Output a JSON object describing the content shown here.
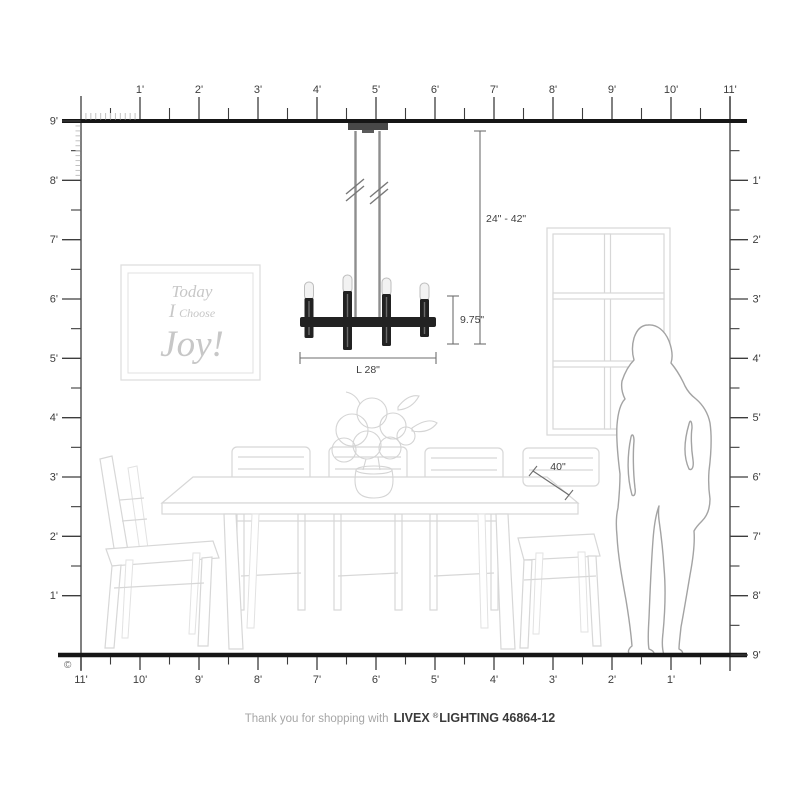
{
  "diagram": {
    "copyright": "©",
    "footer": {
      "prefix": "Thank you for shopping with",
      "brand": "LIVEX",
      "reg": "®",
      "suffix": "LIGHTING 46864-12"
    },
    "dimensions": {
      "hanging_range": "24\" - 42\"",
      "fixture_height": "9.75\"",
      "fixture_length": "L 28\"",
      "table_depth": "40\""
    },
    "wall_art": {
      "line1": "Today",
      "line2_word1": "I",
      "line2_word2": "Choose",
      "line3": "Joy!"
    },
    "rulers": {
      "top": [
        "1'",
        "2'",
        "3'",
        "4'",
        "5'",
        "6'",
        "7'",
        "8'",
        "9'",
        "10'",
        "11'"
      ],
      "left": [
        "9'",
        "8'",
        "7'",
        "6'",
        "5'",
        "4'",
        "3'",
        "2'",
        "1'"
      ],
      "right": [
        "1'",
        "2'",
        "3'",
        "4'",
        "5'",
        "6'",
        "7'",
        "8'",
        "9'"
      ],
      "bottom": [
        "11'",
        "10'",
        "9'",
        "8'",
        "7'",
        "6'",
        "5'",
        "4'",
        "3'",
        "2'",
        "1'"
      ]
    },
    "colors": {
      "fixture_black": "#222222",
      "ruler_dark": "#3d3d3d",
      "fine_tick": "#c2c2c2",
      "furniture_line": "#d7d7d7",
      "figure_line": "#a3a3a3",
      "art_text": "#c7c7c7",
      "footer_muted": "#a6a6a6",
      "footer_dark": "#3a3a3a"
    }
  }
}
